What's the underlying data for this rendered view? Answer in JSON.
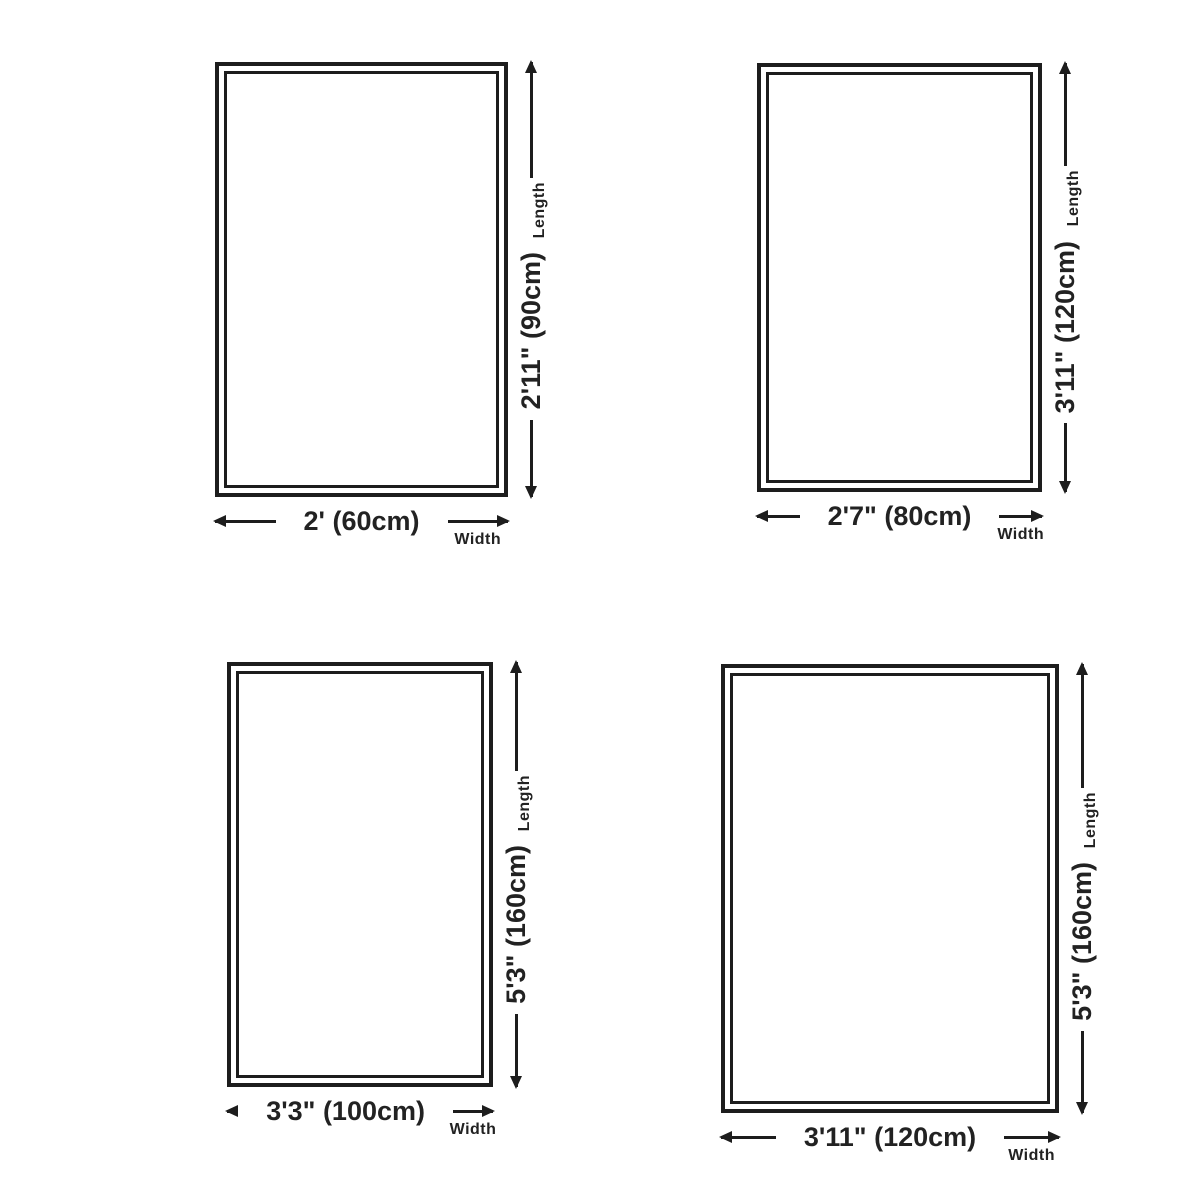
{
  "page": {
    "background": "#ffffff"
  },
  "colors": {
    "line": "#1d1d1d",
    "text": "#222222",
    "rug_fill": "#ffffff"
  },
  "diagrams": [
    {
      "name": "rug-size-60x90",
      "width_value": "2' (60cm)",
      "length_value": "2'11\" (90cm)",
      "width_label": "Width",
      "length_label": "Length"
    },
    {
      "name": "rug-size-80x120",
      "width_value": "2'7\" (80cm)",
      "length_value": "3'11\" (120cm)",
      "width_label": "Width",
      "length_label": "Length"
    },
    {
      "name": "rug-size-100x160",
      "width_value": "3'3\" (100cm)",
      "length_value": "5'3\" (160cm)",
      "width_label": "Width",
      "length_label": "Length"
    },
    {
      "name": "rug-size-120x160",
      "width_value": "3'11\" (120cm)",
      "length_value": "5'3\" (160cm)",
      "width_label": "Width",
      "length_label": "Length"
    }
  ]
}
